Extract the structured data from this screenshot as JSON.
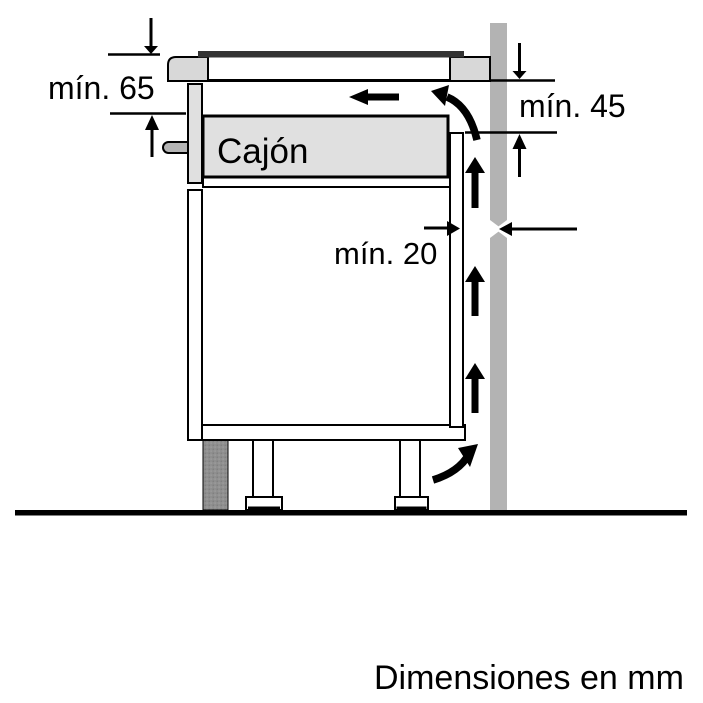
{
  "diagram": {
    "drawer_label": "Cajón",
    "dimensions": {
      "hob_depth": "mín. 65",
      "wall_clearance": "mín. 45",
      "rear_gap": "mín. 20"
    },
    "caption": "Dimensiones en mm"
  },
  "colors": {
    "background": "#ffffff",
    "line": "#000000",
    "glass_dark": "#333333",
    "wall_gray": "#b3b3b3",
    "worktop_gray": "#d8d8d8",
    "drawer_gray": "#e0e0e0",
    "handle_gray": "#b5b5b5",
    "plinth_gray": "#8f8f8f"
  }
}
